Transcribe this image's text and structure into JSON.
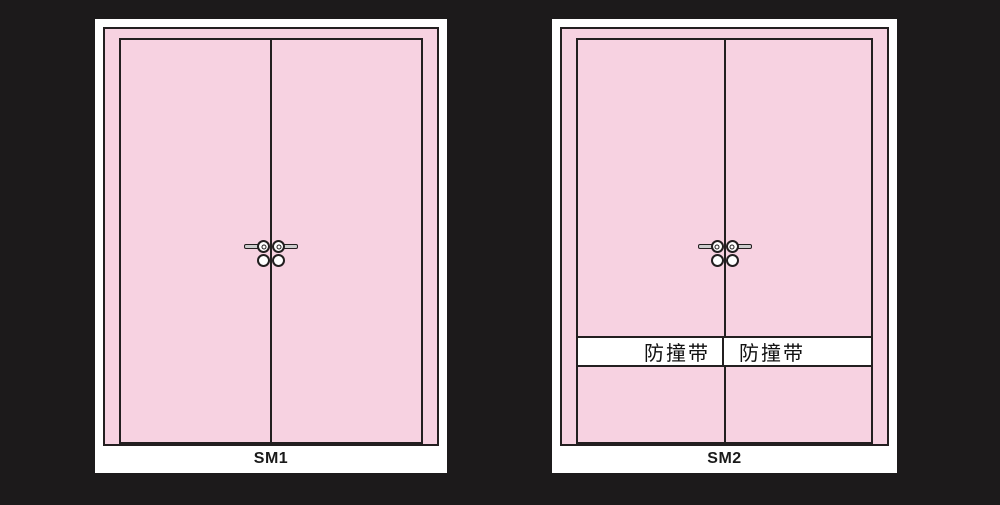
{
  "diagram": {
    "type": "door-elevation-drawings",
    "background_color": "#1c1a1b",
    "colors": {
      "door_pink": "#f7d2e1",
      "outline": "#231f20",
      "panel_white": "#ffffff",
      "handle_gray": "#cccccc"
    }
  },
  "doors": [
    {
      "label": "SM1",
      "style": "double-leaf swing door, plain leaves",
      "has_impact_band": false
    },
    {
      "label": "SM2",
      "style": "double-leaf swing door with impact strips",
      "has_impact_band": true,
      "impact_band": {
        "left_label": "防撞带",
        "right_label": "防撞带"
      }
    }
  ]
}
